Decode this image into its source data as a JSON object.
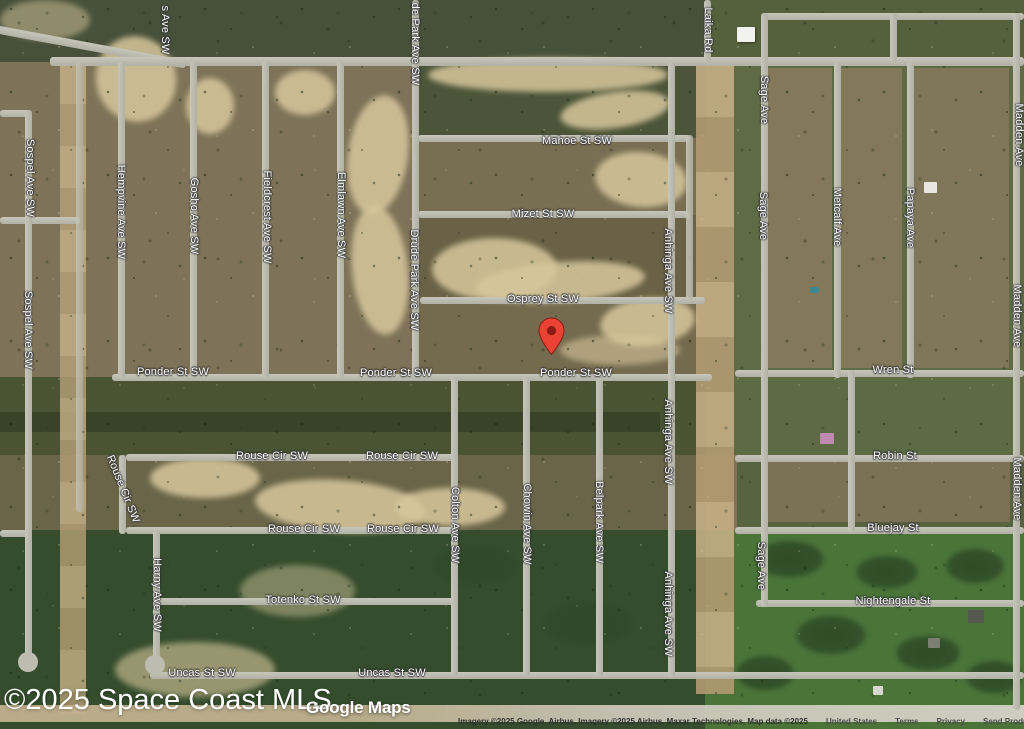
{
  "map": {
    "watermark": "©2025 Space Coast MLS",
    "maps_logo": "Google Maps",
    "attribution": {
      "imagery": "Imagery ©2025 Google, Airbus, Imagery ©2025 Airbus, Maxar Technologies, Map data ©2025",
      "region": "United States",
      "links": [
        "Terms",
        "Privacy",
        "Send Product Feedback"
      ]
    },
    "pin": {
      "color": "#EA4335",
      "dot_color": "#8A1C13",
      "x": 551,
      "y": 355
    },
    "street_labels": [
      {
        "text": "s Ave SW",
        "x": 165,
        "y": 30,
        "dir": "v"
      },
      {
        "text": "de Park Ave SW",
        "x": 415,
        "y": 44,
        "dir": "v"
      },
      {
        "text": "Laika Rd",
        "x": 708,
        "y": 30,
        "dir": "v"
      },
      {
        "text": "Sage Ave",
        "x": 764,
        "y": 100,
        "dir": "v"
      },
      {
        "text": "Madden Ave",
        "x": 1019,
        "y": 135,
        "dir": "v"
      },
      {
        "text": "Sospel Ave SW",
        "x": 30,
        "y": 178,
        "dir": "v"
      },
      {
        "text": "Hempvine Ave SW",
        "x": 121,
        "y": 212,
        "dir": "v"
      },
      {
        "text": "Gosho Ave SW",
        "x": 194,
        "y": 216,
        "dir": "v"
      },
      {
        "text": "Fieldcrest Ave SW",
        "x": 267,
        "y": 217,
        "dir": "v"
      },
      {
        "text": "Elmlawn Ave SW",
        "x": 341,
        "y": 215,
        "dir": "v"
      },
      {
        "text": "Drude Park Ave SW",
        "x": 414,
        "y": 280,
        "dir": "v"
      },
      {
        "text": "Anhinga Ave SW",
        "x": 668,
        "y": 271,
        "dir": "v"
      },
      {
        "text": "Sage Ave",
        "x": 763,
        "y": 216,
        "dir": "v"
      },
      {
        "text": "Metcalf Ave",
        "x": 837,
        "y": 217,
        "dir": "v"
      },
      {
        "text": "Papaya Ave",
        "x": 910,
        "y": 218,
        "dir": "v"
      },
      {
        "text": "Madden Ave",
        "x": 1017,
        "y": 316,
        "dir": "v"
      },
      {
        "text": "Mahoe St SW",
        "x": 577,
        "y": 141,
        "dir": "h"
      },
      {
        "text": "Mizet St SW",
        "x": 543,
        "y": 214,
        "dir": "h"
      },
      {
        "text": "Osprey St SW",
        "x": 543,
        "y": 299,
        "dir": "h"
      },
      {
        "text": "Sospel Ave SW",
        "x": 28,
        "y": 330,
        "dir": "v"
      },
      {
        "text": "Ponder St SW",
        "x": 173,
        "y": 372,
        "dir": "h"
      },
      {
        "text": "Ponder St SW",
        "x": 396,
        "y": 373,
        "dir": "h"
      },
      {
        "text": "Ponder St SW",
        "x": 576,
        "y": 373,
        "dir": "h"
      },
      {
        "text": "Wren St",
        "x": 893,
        "y": 370,
        "dir": "h"
      },
      {
        "text": "Anhinga Ave SW",
        "x": 668,
        "y": 442,
        "dir": "v"
      },
      {
        "text": "Rouse Cir SW",
        "x": 123,
        "y": 489,
        "dir": "t"
      },
      {
        "text": "Rouse Cir SW",
        "x": 272,
        "y": 456,
        "dir": "h"
      },
      {
        "text": "Rouse Cir SW",
        "x": 402,
        "y": 456,
        "dir": "h"
      },
      {
        "text": "Robin St",
        "x": 895,
        "y": 456,
        "dir": "h"
      },
      {
        "text": "Madden Ave",
        "x": 1017,
        "y": 489,
        "dir": "v"
      },
      {
        "text": "Rouse Cir SW",
        "x": 304,
        "y": 529,
        "dir": "h"
      },
      {
        "text": "Rouse Cir SW",
        "x": 403,
        "y": 529,
        "dir": "h"
      },
      {
        "text": "Bluejay St",
        "x": 893,
        "y": 528,
        "dir": "h"
      },
      {
        "text": "Colton Ave SW",
        "x": 455,
        "y": 525,
        "dir": "v"
      },
      {
        "text": "Chowin Ave SW",
        "x": 527,
        "y": 524,
        "dir": "v"
      },
      {
        "text": "Belpark Ave SW",
        "x": 599,
        "y": 522,
        "dir": "v"
      },
      {
        "text": "Sage Ave",
        "x": 761,
        "y": 566,
        "dir": "v"
      },
      {
        "text": "Harny Ave SW",
        "x": 157,
        "y": 595,
        "dir": "v"
      },
      {
        "text": "Totenko St SW",
        "x": 303,
        "y": 600,
        "dir": "h"
      },
      {
        "text": "Nightengale St",
        "x": 893,
        "y": 601,
        "dir": "h"
      },
      {
        "text": "Anhinga Ave SW",
        "x": 668,
        "y": 614,
        "dir": "v"
      },
      {
        "text": "Uncas St SW",
        "x": 202,
        "y": 673,
        "dir": "h"
      },
      {
        "text": "Uncas St SW",
        "x": 392,
        "y": 673,
        "dir": "h"
      }
    ]
  }
}
